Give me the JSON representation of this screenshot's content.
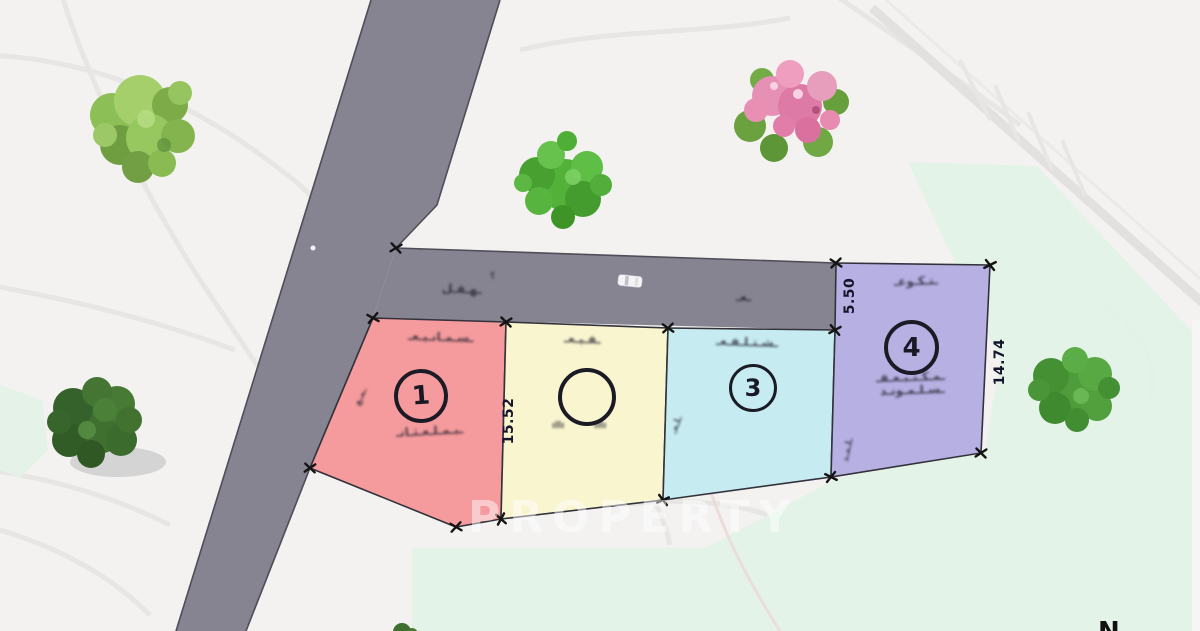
{
  "plots": [
    {
      "name": "plot-1",
      "number": "1"
    },
    {
      "name": "plot-2",
      "number": ""
    },
    {
      "name": "plot-3",
      "number": "3"
    },
    {
      "name": "plot-4",
      "number": "4"
    }
  ],
  "dimensions": [
    {
      "label": "15.52"
    },
    {
      "label": "5.50"
    },
    {
      "label": "14.74"
    }
  ],
  "watermark": "PROPERTY",
  "north_label": "N",
  "colors": {
    "background": "#f3f2f1",
    "mint": "#e3f2e7",
    "road": "#878492",
    "road_edge": "#504d57",
    "plot_stroke": "#33323b",
    "plot1": "#f59b9d",
    "plot2": "#f9f5cf",
    "plot3": "#c6ecf2",
    "plot4": "#b7b1e3"
  },
  "scribbles": {
    "p1_top": {
      "text": "ـسـمـانـيـعـ"
    },
    "p1_center": {
      "text": "ـبـمـلـعـثـانـ"
    },
    "p1_edge": {
      "text": "ـمـع"
    },
    "p2_top": {
      "text": "ـفـيـعـ"
    },
    "p2_sub1": {
      "text": "ıllı"
    },
    "p2_sub2": {
      "text": "ıllı"
    },
    "p3_top": {
      "text": "ـشـتـلـفـعـ"
    },
    "p3_edge": {
      "text": "ـلـعـ"
    },
    "p4_top": {
      "text": "ـتـكـوعـ"
    },
    "p4_center1": {
      "text": "ـمـكـتـبـعـقـ"
    },
    "p4_center2": {
      "text": "ـسـلـمـونـد"
    },
    "p4_edge": {
      "text": "ـلـمـد"
    },
    "road_1": {
      "text": "ـهـقـل"
    },
    "road_q": {
      "text": "؟"
    },
    "road_2": {
      "text": "ـعـ"
    }
  }
}
